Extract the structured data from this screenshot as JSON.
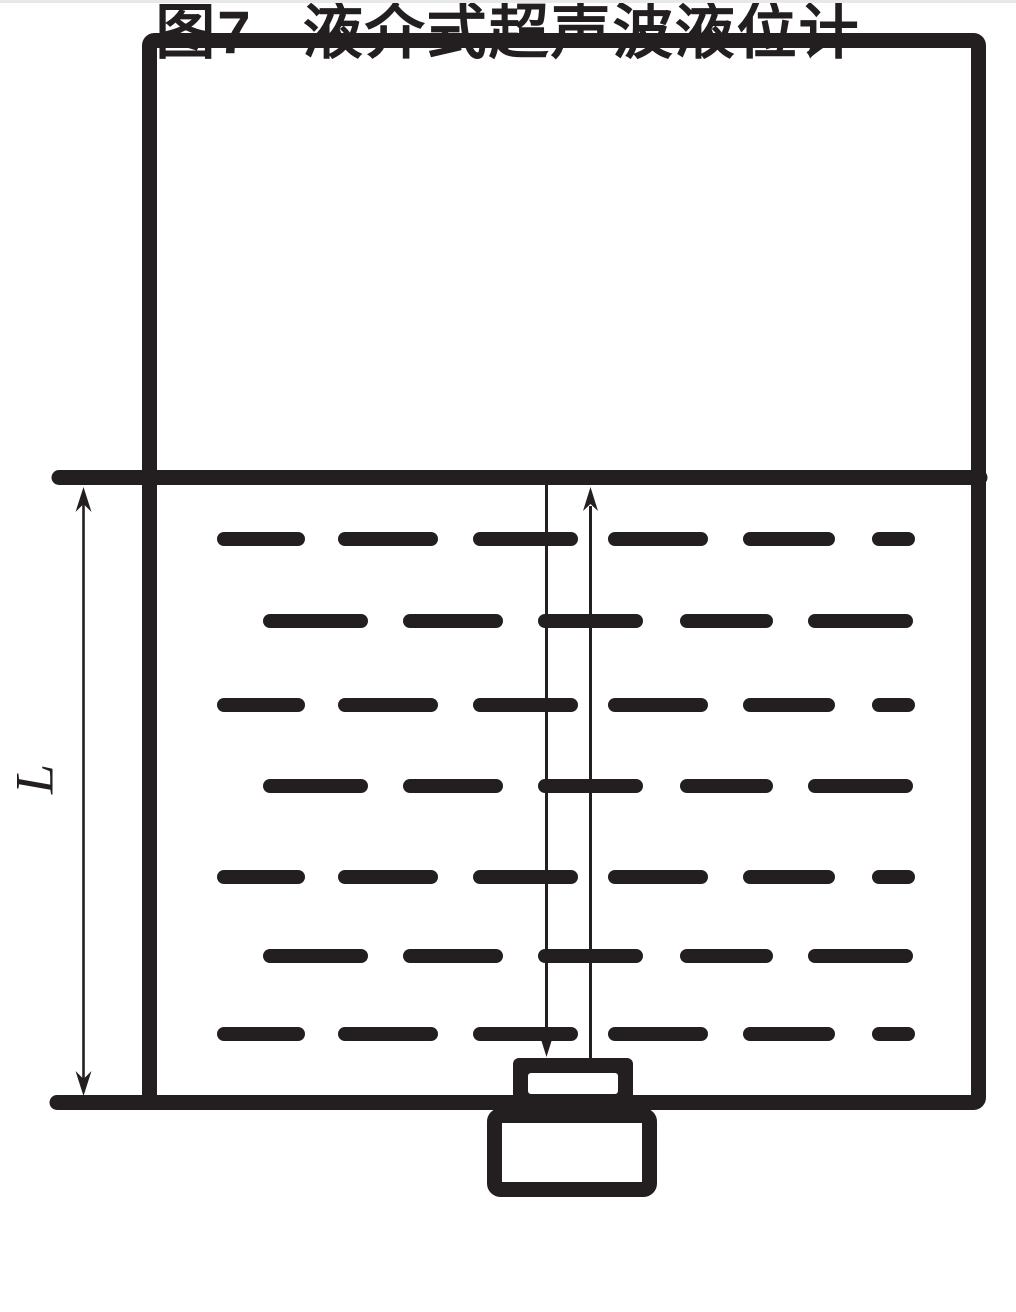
{
  "caption": {
    "number": "图7",
    "title": "液介式超声波液位计"
  },
  "dimension_label": {
    "text": "L"
  },
  "colors": {
    "ink": "#231f20",
    "background": "#ffffff",
    "separator_line": "#e8e8e8"
  },
  "diagram": {
    "liquid_dashes": {
      "row_y": [
        539,
        621,
        705,
        786,
        877,
        956,
        1034
      ],
      "row_patterns": [
        "A",
        "B",
        "A",
        "B",
        "A",
        "B",
        "A"
      ],
      "patterns": {
        "A": [
          [
            217,
            305
          ],
          [
            338,
            438
          ],
          [
            473,
            578
          ],
          [
            608,
            708
          ],
          [
            743,
            835
          ],
          [
            872,
            915
          ]
        ],
        "B": [
          [
            263,
            368
          ],
          [
            403,
            503
          ],
          [
            538,
            643
          ],
          [
            680,
            773
          ],
          [
            808,
            913
          ]
        ]
      },
      "thickness": 14
    }
  }
}
